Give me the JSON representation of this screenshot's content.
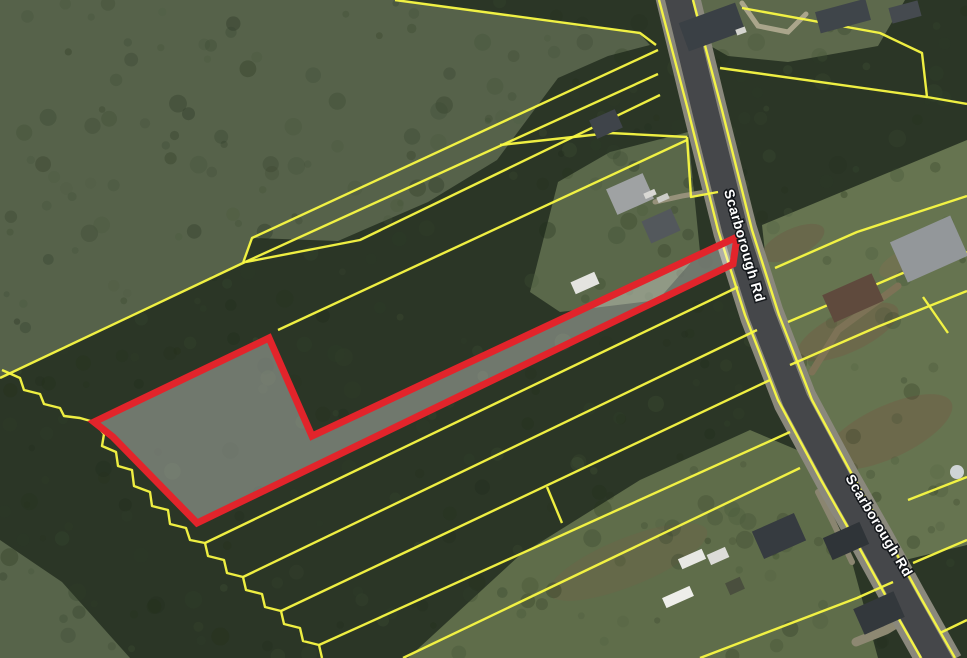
{
  "map": {
    "title": "aerial-parcel-map",
    "colors": {
      "base_trees": "#2b3626",
      "parcel_line": "#f9f943",
      "subject_stroke": "#e2242b",
      "subject_fill": "rgba(255,255,255,0.33)",
      "road_shoulder": "#8a887c",
      "road_asphalt": "#45474a",
      "label_text": "#ffffff",
      "label_halo": "#15181c"
    },
    "road_labels": [
      {
        "text": "Scarborough Rd",
        "x": 740,
        "y": 247,
        "rotation": 74,
        "size": 14
      },
      {
        "text": "Scarborough Rd",
        "x": 875,
        "y": 528,
        "rotation": 59,
        "size": 14
      }
    ],
    "road": {
      "centerline": [
        [
          676,
          -10
        ],
        [
          705,
          110
        ],
        [
          735,
          230
        ],
        [
          762,
          315
        ],
        [
          795,
          400
        ],
        [
          838,
          480
        ],
        [
          872,
          540
        ],
        [
          905,
          600
        ],
        [
          942,
          666
        ]
      ],
      "shoulder_width": 44,
      "asphalt_width": 26
    },
    "terrain": {
      "fields": [
        {
          "name": "upper-left-field",
          "color": "#56624a",
          "points": [
            [
              0,
              0
            ],
            [
              400,
              0
            ],
            [
              638,
              32
            ],
            [
              650,
              45
            ],
            [
              608,
              56
            ],
            [
              558,
              78
            ],
            [
              497,
              160
            ],
            [
              428,
              202
            ],
            [
              338,
              241
            ],
            [
              253,
              238
            ],
            [
              243,
              263
            ],
            [
              0,
              378
            ]
          ]
        },
        {
          "name": "top-right-lawn",
          "color": "#5d694c",
          "points": [
            [
              690,
              0
            ],
            [
              905,
              0
            ],
            [
              878,
              46
            ],
            [
              788,
              62
            ],
            [
              728,
              56
            ],
            [
              700,
              40
            ]
          ]
        },
        {
          "name": "east-lawn",
          "color": "#667450",
          "points": [
            [
              762,
              225
            ],
            [
              967,
              140
            ],
            [
              967,
              545
            ],
            [
              905,
              560
            ],
            [
              853,
              478
            ],
            [
              798,
              358
            ],
            [
              768,
              280
            ]
          ]
        },
        {
          "name": "bottom-center-lawn",
          "color": "#5f6d4a",
          "points": [
            [
              408,
              658
            ],
            [
              520,
              555
            ],
            [
              640,
              480
            ],
            [
              750,
              430
            ],
            [
              802,
              452
            ],
            [
              852,
              562
            ],
            [
              878,
              658
            ]
          ]
        },
        {
          "name": "bottom-left-lawn",
          "color": "#57644a",
          "points": [
            [
              0,
              540
            ],
            [
              62,
              582
            ],
            [
              130,
              658
            ],
            [
              0,
              658
            ]
          ]
        },
        {
          "name": "mid-left-lawn",
          "color": "#5a684a",
          "points": [
            [
              530,
              292
            ],
            [
              558,
              182
            ],
            [
              610,
              152
            ],
            [
              688,
              132
            ],
            [
              700,
              252
            ],
            [
              658,
              300
            ],
            [
              560,
              312
            ]
          ]
        }
      ],
      "brown_patches": [
        {
          "cx": 848,
          "cy": 332,
          "rx": 55,
          "ry": 20,
          "rot": -25,
          "color": "#6f6549",
          "opacity": 0.75
        },
        {
          "cx": 888,
          "cy": 432,
          "rx": 70,
          "ry": 26,
          "rot": -25,
          "color": "#6f6549",
          "opacity": 0.7
        },
        {
          "cx": 793,
          "cy": 243,
          "rx": 34,
          "ry": 14,
          "rot": -25,
          "color": "#6b6147",
          "opacity": 0.6
        },
        {
          "cx": 628,
          "cy": 562,
          "rx": 85,
          "ry": 24,
          "rot": -22,
          "color": "#6a6648",
          "opacity": 0.55
        },
        {
          "cx": 905,
          "cy": 262,
          "rx": 28,
          "ry": 12,
          "rot": -25,
          "color": "#79704f",
          "opacity": 0.5
        }
      ]
    },
    "driveways": [
      {
        "points": [
          [
            812,
            372
          ],
          [
            838,
            330
          ],
          [
            898,
            286
          ]
        ],
        "width": 7,
        "color": "#7d7256"
      },
      {
        "points": [
          [
            742,
            3
          ],
          [
            758,
            26
          ],
          [
            788,
            32
          ],
          [
            806,
            14
          ]
        ],
        "width": 5,
        "color": "#aaa58b"
      },
      {
        "points": [
          [
            718,
            190
          ],
          [
            682,
            196
          ],
          [
            655,
            202
          ]
        ],
        "width": 5,
        "color": "#96917a"
      },
      {
        "points": [
          [
            922,
            608
          ],
          [
            886,
            630
          ],
          [
            856,
            642
          ]
        ],
        "width": 9,
        "color": "#8d8872"
      },
      {
        "points": [
          [
            852,
            562
          ],
          [
            832,
            520
          ],
          [
            818,
            492
          ]
        ],
        "width": 6,
        "color": "#8a8570"
      }
    ],
    "parcel_lines": [
      {
        "name": "field-boundary-west",
        "points": [
          [
            0,
            378
          ],
          [
            243,
            263
          ],
          [
            252,
            238
          ],
          [
            658,
            50
          ]
        ]
      },
      {
        "name": "strip-line-north-1",
        "points": [
          [
            243,
            263
          ],
          [
            658,
            74
          ]
        ]
      },
      {
        "name": "strip-line-north-2",
        "points": [
          [
            246,
            262
          ],
          [
            360,
            240
          ],
          [
            660,
            95
          ]
        ]
      },
      {
        "name": "line-above-subject",
        "points": [
          [
            278,
            330
          ],
          [
            687,
            140
          ]
        ]
      },
      {
        "name": "branch-to-road",
        "points": [
          [
            500,
            145
          ],
          [
            610,
            133
          ],
          [
            687,
            137
          ]
        ]
      },
      {
        "name": "road-jog",
        "points": [
          [
            687,
            137
          ],
          [
            691,
            197
          ],
          [
            718,
            192
          ]
        ]
      },
      {
        "name": "top-field-line",
        "points": [
          [
            395,
            0
          ],
          [
            640,
            33
          ],
          [
            656,
            45
          ]
        ]
      },
      {
        "name": "creek-boundary",
        "points": [
          [
            2,
            370
          ],
          [
            20,
            378
          ],
          [
            24,
            390
          ],
          [
            40,
            394
          ],
          [
            44,
            404
          ],
          [
            60,
            408
          ],
          [
            64,
            416
          ],
          [
            80,
            418
          ],
          [
            94,
            422
          ],
          [
            104,
            434
          ],
          [
            102,
            446
          ],
          [
            116,
            452
          ],
          [
            118,
            466
          ],
          [
            132,
            470
          ],
          [
            134,
            486
          ],
          [
            150,
            492
          ],
          [
            152,
            506
          ],
          [
            168,
            510
          ],
          [
            170,
            524
          ],
          [
            186,
            528
          ],
          [
            190,
            540
          ],
          [
            205,
            543
          ],
          [
            208,
            556
          ],
          [
            224,
            560
          ],
          [
            227,
            573
          ],
          [
            243,
            577
          ],
          [
            246,
            590
          ],
          [
            262,
            594
          ],
          [
            265,
            607
          ],
          [
            281,
            611
          ],
          [
            284,
            624
          ],
          [
            300,
            628
          ],
          [
            303,
            641
          ],
          [
            319,
            645
          ],
          [
            322,
            658
          ]
        ]
      },
      {
        "name": "south-strip-1",
        "points": [
          [
            205,
            543
          ],
          [
            738,
            287
          ]
        ]
      },
      {
        "name": "south-strip-2",
        "points": [
          [
            243,
            577
          ],
          [
            757,
            330
          ]
        ]
      },
      {
        "name": "south-strip-3",
        "points": [
          [
            281,
            611
          ],
          [
            770,
            380
          ]
        ]
      },
      {
        "name": "south-strip-connector",
        "points": [
          [
            547,
            487
          ],
          [
            562,
            523
          ]
        ]
      },
      {
        "name": "south-strip-4",
        "points": [
          [
            319,
            645
          ],
          [
            790,
            432
          ]
        ]
      },
      {
        "name": "south-strip-5",
        "points": [
          [
            403,
            658
          ],
          [
            800,
            468
          ]
        ]
      },
      {
        "name": "south-strip-6",
        "points": [
          [
            700,
            658
          ],
          [
            857,
            598
          ],
          [
            893,
            582
          ]
        ]
      },
      {
        "name": "northeast-parcel",
        "points": [
          [
            742,
            8
          ],
          [
            880,
            33
          ],
          [
            922,
            53
          ],
          [
            927,
            97
          ],
          [
            967,
            104
          ]
        ]
      },
      {
        "name": "northeast-lower",
        "points": [
          [
            720,
            68
          ],
          [
            927,
            97
          ]
        ]
      },
      {
        "name": "east-line-1",
        "points": [
          [
            775,
            268
          ],
          [
            857,
            232
          ],
          [
            967,
            196
          ]
        ]
      },
      {
        "name": "east-line-2",
        "points": [
          [
            788,
            322
          ],
          [
            903,
            273
          ],
          [
            967,
            252
          ]
        ]
      },
      {
        "name": "east-line-3",
        "points": [
          [
            790,
            365
          ],
          [
            877,
            327
          ],
          [
            967,
            291
          ]
        ]
      },
      {
        "name": "east-connector",
        "points": [
          [
            923,
            297
          ],
          [
            948,
            333
          ]
        ]
      },
      {
        "name": "east-line-4",
        "points": [
          [
            908,
            500
          ],
          [
            967,
            477
          ]
        ]
      },
      {
        "name": "east-line-5",
        "points": [
          [
            913,
            563
          ],
          [
            967,
            540
          ]
        ]
      },
      {
        "name": "east-line-6",
        "points": [
          [
            940,
            633
          ],
          [
            967,
            620
          ]
        ]
      },
      {
        "name": "road-edge-west",
        "points": [
          [
            659,
            0
          ],
          [
            688,
            110
          ],
          [
            718,
            230
          ],
          [
            745,
            315
          ],
          [
            778,
            400
          ],
          [
            821,
            480
          ],
          [
            855,
            540
          ],
          [
            888,
            600
          ],
          [
            921,
            658
          ]
        ]
      },
      {
        "name": "road-edge-east",
        "points": [
          [
            693,
            0
          ],
          [
            722,
            110
          ],
          [
            752,
            230
          ],
          [
            779,
            315
          ],
          [
            812,
            400
          ],
          [
            855,
            480
          ],
          [
            889,
            540
          ],
          [
            922,
            600
          ],
          [
            955,
            658
          ]
        ]
      }
    ],
    "subject_parcel": {
      "name": "highlighted-parcel",
      "points": [
        [
          94,
          422
        ],
        [
          269,
          338
        ],
        [
          312,
          436
        ],
        [
          737,
          237
        ],
        [
          733,
          264
        ],
        [
          197,
          523
        ],
        [
          113,
          437
        ]
      ],
      "stroke_width": 7
    },
    "houses": [
      {
        "cx": 712,
        "cy": 27,
        "w": 60,
        "h": 30,
        "rot": -20,
        "color": "#3a4045"
      },
      {
        "cx": 843,
        "cy": 16,
        "w": 52,
        "h": 22,
        "rot": -15,
        "color": "#3f454a"
      },
      {
        "cx": 905,
        "cy": 12,
        "w": 30,
        "h": 16,
        "rot": -15,
        "color": "#454a4f"
      },
      {
        "cx": 606,
        "cy": 124,
        "w": 28,
        "h": 20,
        "rot": -24,
        "color": "#3f444a"
      },
      {
        "cx": 630,
        "cy": 194,
        "w": 40,
        "h": 28,
        "rot": -24,
        "color": "#9fa2a3"
      },
      {
        "cx": 661,
        "cy": 226,
        "w": 32,
        "h": 24,
        "rot": -24,
        "color": "#53585c"
      },
      {
        "cx": 929,
        "cy": 249,
        "w": 66,
        "h": 44,
        "rot": -24,
        "color": "#93979a"
      },
      {
        "cx": 853,
        "cy": 298,
        "w": 54,
        "h": 30,
        "rot": -24,
        "color": "#5f4a3d"
      },
      {
        "cx": 779,
        "cy": 536,
        "w": 46,
        "h": 30,
        "rot": -24,
        "color": "#363b40"
      },
      {
        "cx": 846,
        "cy": 541,
        "w": 40,
        "h": 24,
        "rot": -24,
        "color": "#2f3438"
      },
      {
        "cx": 879,
        "cy": 613,
        "w": 44,
        "h": 28,
        "rot": -24,
        "color": "#33383c"
      },
      {
        "cx": 692,
        "cy": 559,
        "w": 26,
        "h": 11,
        "rot": -24,
        "color": "#e8e8e4"
      },
      {
        "cx": 718,
        "cy": 556,
        "w": 20,
        "h": 11,
        "rot": -24,
        "color": "#dcdcd8"
      },
      {
        "cx": 678,
        "cy": 597,
        "w": 30,
        "h": 11,
        "rot": -24,
        "color": "#eeeeea"
      },
      {
        "cx": 735,
        "cy": 586,
        "w": 16,
        "h": 13,
        "rot": -24,
        "color": "#4a4f3e"
      },
      {
        "cx": 585,
        "cy": 283,
        "w": 26,
        "h": 13,
        "rot": -24,
        "color": "#e4e4e0"
      },
      {
        "cx": 650,
        "cy": 194,
        "w": 12,
        "h": 6,
        "rot": -24,
        "color": "#d8d8d4"
      },
      {
        "cx": 663,
        "cy": 198,
        "w": 12,
        "h": 6,
        "rot": -24,
        "color": "#cccdc8"
      },
      {
        "cx": 741,
        "cy": 31,
        "w": 10,
        "h": 6,
        "rot": -20,
        "color": "#d5d5d0"
      }
    ],
    "circles": [
      {
        "cx": 957,
        "cy": 472,
        "r": 7,
        "color": "#cfd4d6"
      }
    ]
  }
}
